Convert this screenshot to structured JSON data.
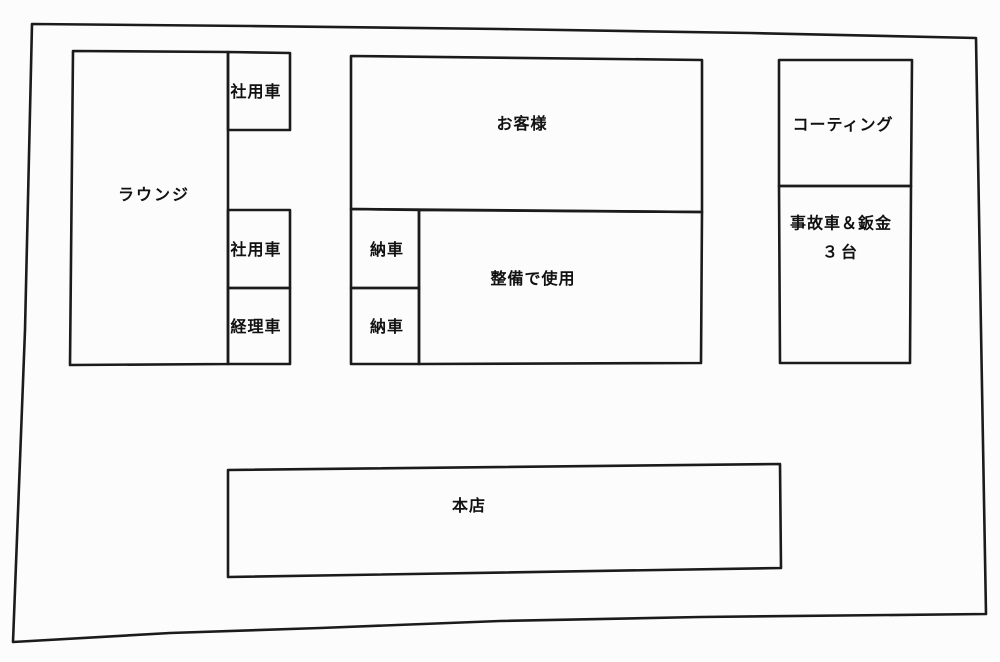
{
  "diagram": {
    "title": "parking-lot-layout-sketch",
    "line_color": "#1b1b1b",
    "paper_color": "#fcfcfc",
    "areas": {
      "lounge": {
        "label": "ラウンジ"
      },
      "company_car_top": {
        "label": "社用車"
      },
      "company_car_mid": {
        "label": "社用車"
      },
      "accounting_car": {
        "label": "経理車"
      },
      "customer": {
        "label": "お客様"
      },
      "delivery_top": {
        "label": "納車"
      },
      "delivery_bottom": {
        "label": "納車"
      },
      "maintenance": {
        "label": "整備で使用"
      },
      "coating": {
        "label": "コーティング"
      },
      "accident_bodywork": {
        "label_line1": "事故車＆鈑金",
        "label_line2": "３台"
      },
      "main_store": {
        "label": "本店"
      }
    }
  }
}
